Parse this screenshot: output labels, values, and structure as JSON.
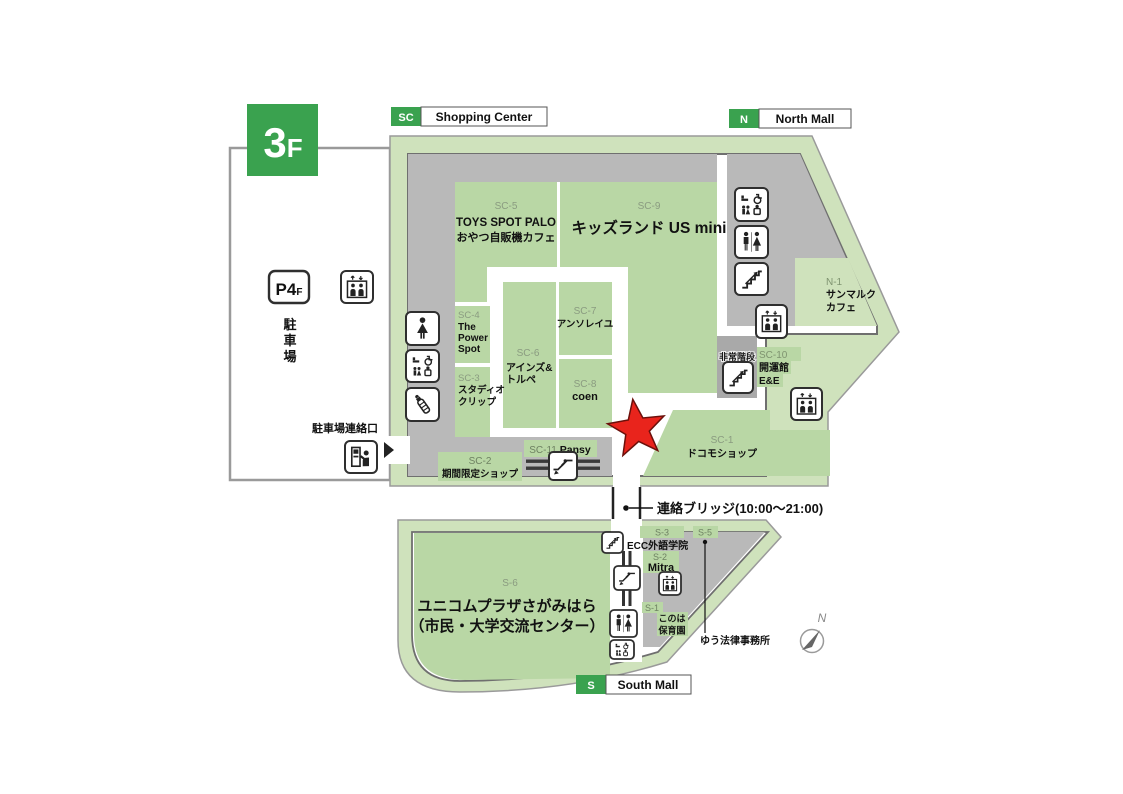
{
  "floor": {
    "big": "3",
    "small": "F"
  },
  "legend": {
    "sc": {
      "code": "SC",
      "label": "Shopping Center"
    },
    "north": {
      "code": "N",
      "label": "North Mall"
    },
    "south": {
      "code": "S",
      "label": "South Mall"
    }
  },
  "parking": {
    "badge_big": "P4",
    "badge_small": "F",
    "name_c1": "駐",
    "name_c2": "車",
    "name_c3": "場",
    "gate_label": "駐車場連絡口"
  },
  "bridge": {
    "label": "連絡ブリッジ(10:00〜21:00)"
  },
  "notes": {
    "emergency_stairs": "非常階段",
    "compass": "N"
  },
  "shops": {
    "sc5": {
      "code": "SC-5",
      "line1": "TOYS SPOT PALO",
      "line2": "おやつ自販機カフェ"
    },
    "sc9": {
      "code": "SC-9",
      "name": "キッズランド US mini"
    },
    "sc4": {
      "code": "SC-4",
      "line1": "The",
      "line2": "Power",
      "line3": "Spot"
    },
    "sc3": {
      "code": "SC-3",
      "line1": "スタディオ",
      "line2": "クリップ"
    },
    "sc6": {
      "code": "SC-6",
      "line1": "アインズ&",
      "line2": "トルペ"
    },
    "sc7": {
      "code": "SC-7",
      "name": "アンソレイユ"
    },
    "sc8": {
      "code": "SC-8",
      "name": "coen"
    },
    "sc10": {
      "code": "SC-10",
      "line1": "開運館",
      "line2": "E&E"
    },
    "sc11": {
      "code": "SC-11",
      "name": "Pansy"
    },
    "sc2": {
      "code": "SC-2",
      "name": "期間限定ショップ"
    },
    "sc1": {
      "code": "SC-1",
      "name": "ドコモショップ"
    },
    "n1": {
      "code": "N-1",
      "line1": "サンマルク",
      "line2": "カフェ"
    },
    "s6": {
      "code": "S-6",
      "line1": "ユニコムプラザさがみはら",
      "line2": "（市民・大学交流センター）"
    },
    "s3": {
      "code": "S-3",
      "name": "ECC外語学院"
    },
    "s2": {
      "code": "S-2",
      "name": "Mitra"
    },
    "s5": {
      "code": "S-5",
      "name": "ゆう法律事務所"
    },
    "s1": {
      "code": "S-1",
      "line1": "このは",
      "line2": "保育園"
    }
  },
  "colors": {
    "accent_green": "#3aa24f",
    "band_green": "#cfe2bc",
    "shop_green": "#b9d7a5",
    "corridor_gray": "#b9b9b9",
    "star_red": "#e9241c"
  }
}
